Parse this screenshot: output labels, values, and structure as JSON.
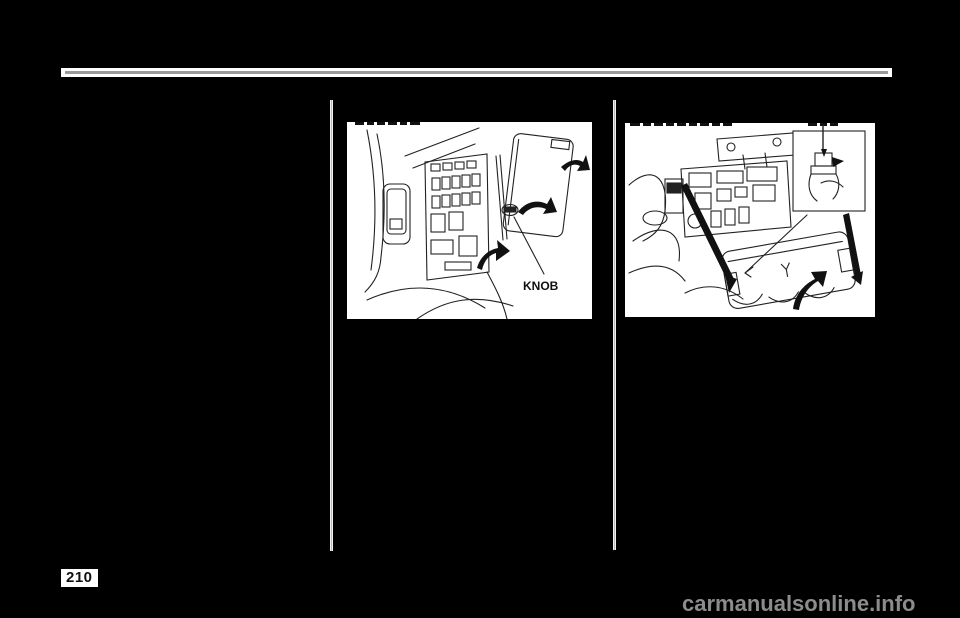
{
  "page": {
    "background_color": "#000000",
    "page_number": "210",
    "rule_color": "#9a9a9a"
  },
  "watermark": {
    "text": "carmanualsonline.info",
    "color": "#8c8c8c"
  },
  "figures": {
    "interior_fuse_box": {
      "name": "interior-fuse-box-illustration",
      "knob_label": "KNOB",
      "top_text_clipped": true
    },
    "underhood_fuse_box": {
      "name": "underhood-fuse-box-illustration",
      "top_text_clipped": true
    }
  }
}
